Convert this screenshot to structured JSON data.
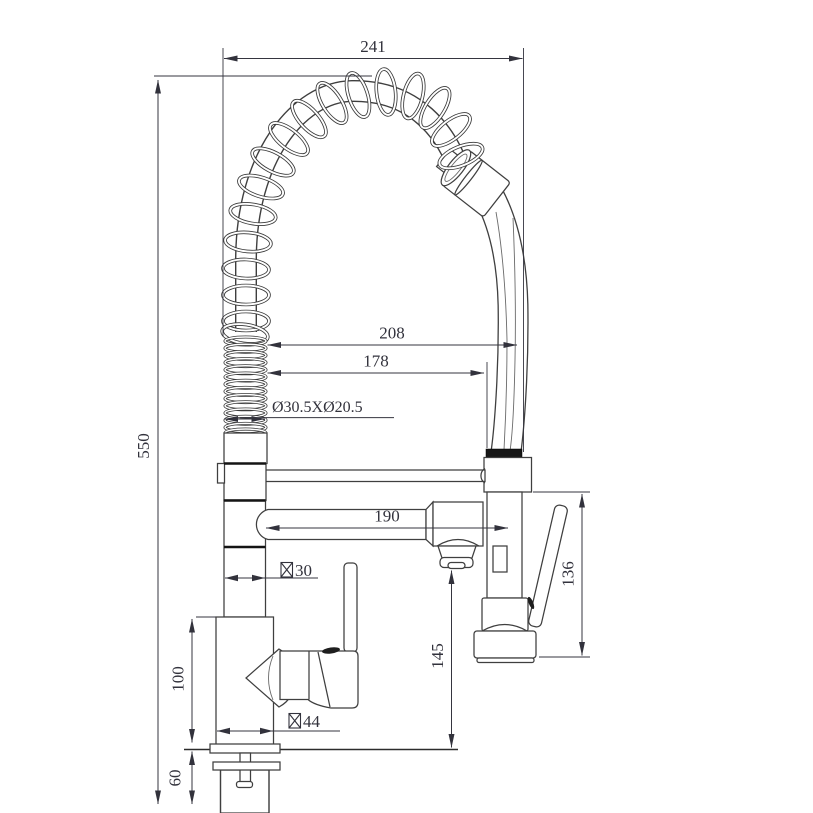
{
  "drawing": {
    "dims": {
      "overall_width": "241",
      "overall_height": "550",
      "reach_outer": "208",
      "reach_inner": "178",
      "spring_spec": "Ø30.5XØ20.5",
      "spout_length": "190",
      "column_dia_value": "30",
      "column_dia_symbol": "☒",
      "handle_height": "136",
      "outlet_height": "145",
      "body_height": "100",
      "body_dia_value": "44",
      "body_dia_symbol": "☒",
      "shank_length": "60"
    }
  }
}
